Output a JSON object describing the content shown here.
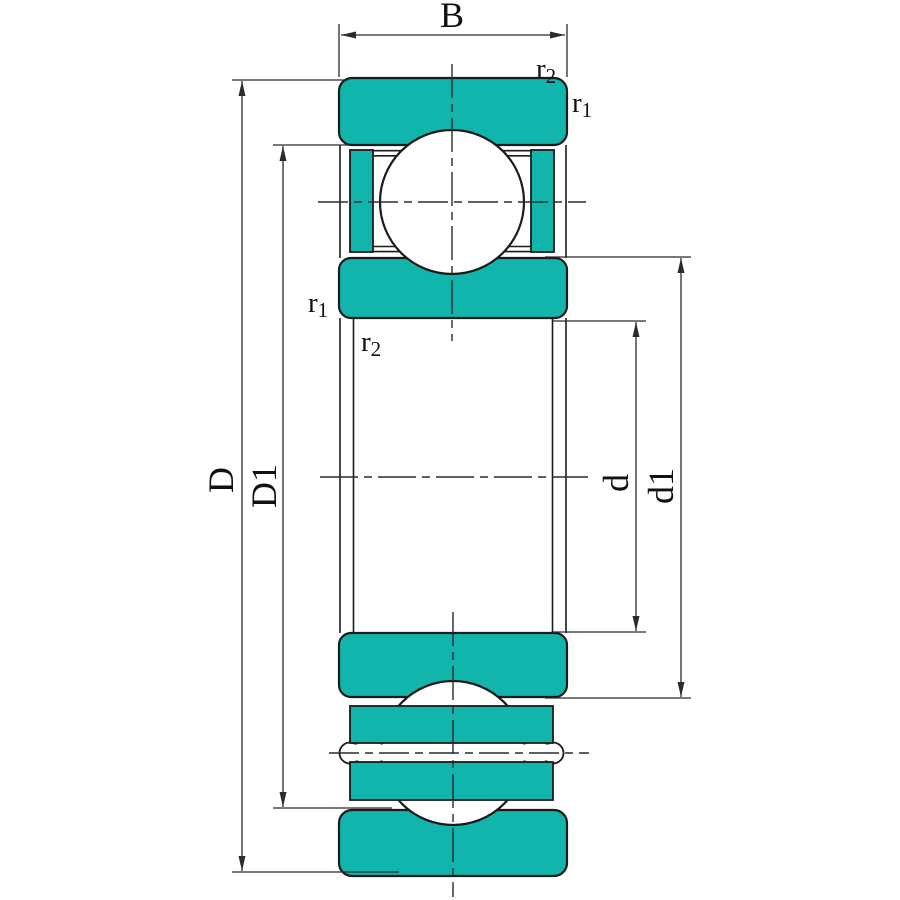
{
  "title": "Deep groove ball bearing cross-section drawing",
  "colors": {
    "ring_fill": "#12b5ac",
    "outline": "#1b1b1b",
    "dimension_line": "#2b2b2b",
    "background": "#ffffff"
  },
  "dimensions": {
    "width": {
      "label": "B"
    },
    "outer_diameter": {
      "label": "D"
    },
    "outer_shoulder_diameter": {
      "label": "D1"
    },
    "bore_diameter": {
      "label": "d"
    },
    "inner_shoulder_diameter": {
      "label": "d1"
    },
    "chamfer_r1": {
      "base": "r",
      "sub": "1"
    },
    "chamfer_r2": {
      "base": "r",
      "sub": "2"
    }
  }
}
